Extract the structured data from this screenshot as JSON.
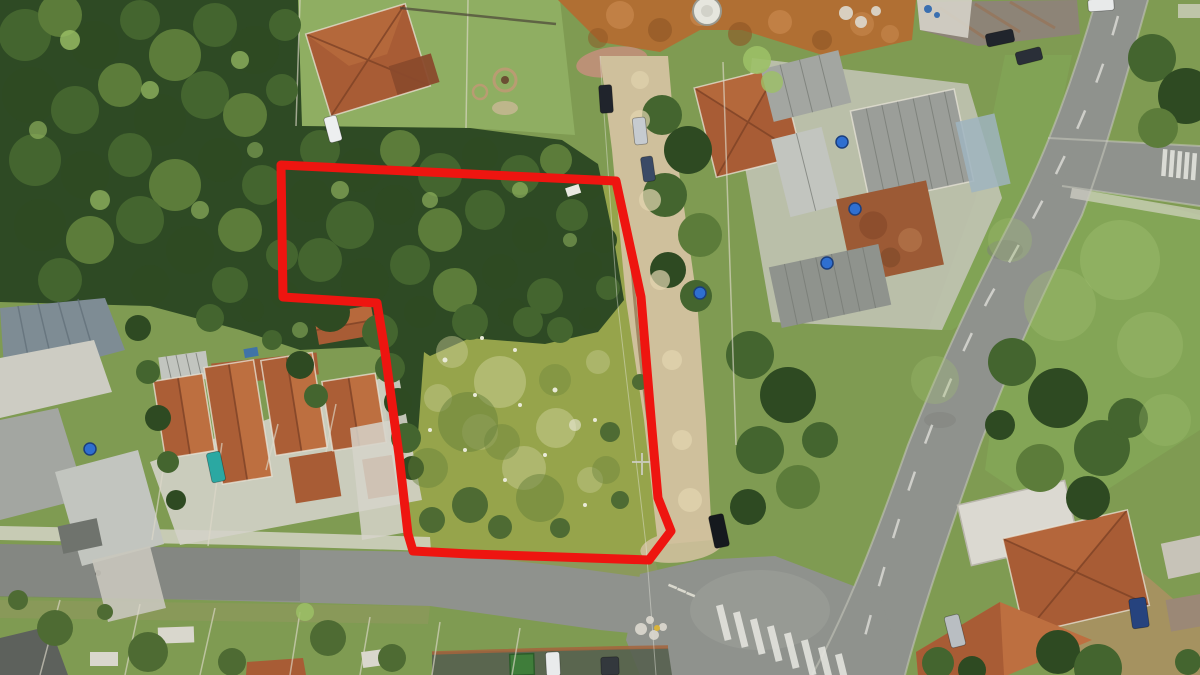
{
  "palette": {
    "grass": "#7f9b52",
    "lawn": "#8fae62",
    "field": "#84aa58",
    "fieldLight": "#a2c172",
    "lotGrass": "#96a44b",
    "lotPale": "#cbcf98",
    "lotDark": "#66803a",
    "forest": "#2e4a24",
    "f1": "#2e4a22",
    "f2": "#44652f",
    "f3": "#5c7c3a",
    "f4": "#4e6b33",
    "c2": "#9cc066",
    "dirt": "#cfc09c",
    "dL": "#e2d5b0",
    "dirtDark": "#a9946f",
    "earth": "#b06f33",
    "eL": "#c5854a",
    "eD": "#8d5524",
    "mound": "#c2907a",
    "asphalt": "#8f928d",
    "asphaltDark": "#747873",
    "asphaltLight": "#a6a9a3",
    "concrete": "#d9d7cd",
    "white": "#e9ead8",
    "w": "#e9ead8",
    "lp": "#cbcf98",
    "ld": "#66803a",
    "fl": "#a2c172",
    "roofOrange": "#a85c35",
    "roofOrangeLight": "#bd6f40",
    "roofOrangeDark": "#7e4226",
    "roofGrey": "#a3a6a1",
    "roofGreyDark": "#848781",
    "roofGreyLight": "#c2c5bf",
    "metalBlue": "#7e8c94",
    "rust": "#8d8477",
    "poolBlue": "#9fb4c0",
    "tankBlue": "#2f6fd0",
    "boundary": "#ee1510"
  },
  "boundary": {
    "points": "281,165 616,181 641,297 652,430 658,498 671,531 649,560 560,557 470,554 413,551 408,534 399,455 385,352 377,303 283,297",
    "stroke_width": 9,
    "color": "#ee1510"
  },
  "scene": {
    "blobs": [
      [
        25,
        35,
        26,
        "f2"
      ],
      [
        60,
        15,
        22,
        "f3"
      ],
      [
        95,
        45,
        24,
        "f1"
      ],
      [
        140,
        20,
        20,
        "f2"
      ],
      [
        175,
        55,
        26,
        "f3"
      ],
      [
        215,
        25,
        22,
        "f2"
      ],
      [
        255,
        50,
        24,
        "f1"
      ],
      [
        285,
        25,
        16,
        "f2"
      ],
      [
        30,
        95,
        28,
        "f1"
      ],
      [
        75,
        110,
        24,
        "f2"
      ],
      [
        120,
        85,
        22,
        "f3"
      ],
      [
        160,
        120,
        26,
        "f1"
      ],
      [
        205,
        95,
        24,
        "f2"
      ],
      [
        245,
        115,
        22,
        "f3"
      ],
      [
        282,
        90,
        16,
        "f2"
      ],
      [
        35,
        160,
        26,
        "f2"
      ],
      [
        85,
        175,
        24,
        "f1"
      ],
      [
        130,
        155,
        22,
        "f2"
      ],
      [
        175,
        185,
        26,
        "f3"
      ],
      [
        220,
        160,
        22,
        "f1"
      ],
      [
        262,
        185,
        20,
        "f2"
      ],
      [
        40,
        225,
        26,
        "f1"
      ],
      [
        90,
        240,
        24,
        "f3"
      ],
      [
        140,
        220,
        24,
        "f2"
      ],
      [
        190,
        250,
        24,
        "f1"
      ],
      [
        240,
        230,
        22,
        "f3"
      ],
      [
        282,
        255,
        16,
        "f2"
      ],
      [
        60,
        280,
        22,
        "f2"
      ],
      [
        150,
        285,
        20,
        "f1"
      ],
      [
        230,
        285,
        18,
        "f2"
      ],
      [
        285,
        295,
        14,
        "f1"
      ],
      [
        320,
        150,
        20,
        "f2"
      ],
      [
        360,
        170,
        22,
        "f1"
      ],
      [
        400,
        150,
        20,
        "f3"
      ],
      [
        440,
        175,
        22,
        "f2"
      ],
      [
        480,
        155,
        18,
        "f1"
      ],
      [
        520,
        175,
        20,
        "f2"
      ],
      [
        556,
        160,
        16,
        "f3"
      ],
      [
        588,
        186,
        14,
        "f1"
      ],
      [
        310,
        200,
        22,
        "f1"
      ],
      [
        350,
        225,
        24,
        "f2"
      ],
      [
        395,
        205,
        20,
        "f1"
      ],
      [
        440,
        230,
        22,
        "f3"
      ],
      [
        485,
        210,
        20,
        "f2"
      ],
      [
        530,
        235,
        18,
        "f1"
      ],
      [
        572,
        215,
        16,
        "f2"
      ],
      [
        604,
        240,
        13,
        "f1"
      ],
      [
        320,
        260,
        22,
        "f2"
      ],
      [
        365,
        282,
        24,
        "f1"
      ],
      [
        410,
        265,
        20,
        "f2"
      ],
      [
        455,
        290,
        22,
        "f3"
      ],
      [
        500,
        272,
        18,
        "f1"
      ],
      [
        545,
        296,
        18,
        "f2"
      ],
      [
        588,
        266,
        14,
        "f1"
      ],
      [
        608,
        288,
        12,
        "f2"
      ],
      [
        330,
        312,
        20,
        "f1"
      ],
      [
        380,
        332,
        18,
        "f2"
      ],
      [
        420,
        312,
        16,
        "f1"
      ],
      [
        470,
        322,
        18,
        "f2"
      ],
      [
        512,
        312,
        14,
        "f1"
      ],
      [
        560,
        330,
        13,
        "f2"
      ],
      [
        590,
        318,
        11,
        "f1"
      ],
      [
        70,
        40,
        10,
        "c2",
        0.8
      ],
      [
        150,
        90,
        9,
        "c2",
        0.7
      ],
      [
        240,
        60,
        9,
        "c2",
        0.7
      ],
      [
        100,
        200,
        10,
        "c2",
        0.7
      ],
      [
        200,
        210,
        9,
        "c2",
        0.6
      ],
      [
        340,
        190,
        9,
        "c2",
        0.6
      ],
      [
        430,
        200,
        8,
        "c2",
        0.6
      ],
      [
        520,
        190,
        8,
        "c2",
        0.6
      ],
      [
        300,
        330,
        8,
        "c2",
        0.5
      ],
      [
        570,
        240,
        7,
        "c2",
        0.5
      ],
      [
        38,
        130,
        9,
        "c2",
        0.6
      ],
      [
        255,
        150,
        8,
        "c2",
        0.5
      ],
      [
        390,
        368,
        15,
        "f2"
      ],
      [
        398,
        402,
        14,
        "f1"
      ],
      [
        406,
        438,
        15,
        "f2"
      ],
      [
        412,
        468,
        12,
        "f1"
      ],
      [
        300,
        365,
        14,
        "f1"
      ],
      [
        316,
        396,
        12,
        "f2"
      ],
      [
        210,
        318,
        14,
        "f2"
      ],
      [
        252,
        310,
        12,
        "f1"
      ],
      [
        272,
        340,
        10,
        "f2"
      ],
      [
        138,
        328,
        13,
        "f1"
      ],
      [
        148,
        372,
        12,
        "f2"
      ],
      [
        158,
        418,
        13,
        "f1"
      ],
      [
        168,
        462,
        11,
        "f2"
      ],
      [
        176,
        500,
        10,
        "f1"
      ],
      [
        662,
        115,
        20,
        "f2"
      ],
      [
        688,
        150,
        24,
        "f1"
      ],
      [
        665,
        195,
        22,
        "f2"
      ],
      [
        700,
        235,
        22,
        "f3"
      ],
      [
        668,
        270,
        18,
        "f1"
      ],
      [
        696,
        296,
        16,
        "f2"
      ],
      [
        757,
        60,
        14,
        "c2",
        0.9
      ],
      [
        772,
        82,
        11,
        "c2",
        0.8
      ],
      [
        750,
        355,
        24,
        "f2"
      ],
      [
        788,
        395,
        28,
        "f1"
      ],
      [
        760,
        450,
        24,
        "f2"
      ],
      [
        798,
        487,
        22,
        "f3"
      ],
      [
        748,
        507,
        18,
        "f1"
      ],
      [
        820,
        440,
        18,
        "f2"
      ],
      [
        1152,
        58,
        24,
        "f2"
      ],
      [
        1186,
        96,
        28,
        "f1"
      ],
      [
        1158,
        128,
        20,
        "f3"
      ],
      [
        1012,
        362,
        24,
        "f2"
      ],
      [
        1058,
        398,
        30,
        "f1"
      ],
      [
        1102,
        448,
        28,
        "f2"
      ],
      [
        1040,
        468,
        24,
        "f3"
      ],
      [
        1088,
        498,
        22,
        "f1"
      ],
      [
        1128,
        418,
        20,
        "f2"
      ],
      [
        1000,
        425,
        15,
        "f1"
      ],
      [
        1058,
        652,
        22,
        "f1"
      ],
      [
        1098,
        668,
        24,
        "f2"
      ],
      [
        938,
        663,
        16,
        "f2"
      ],
      [
        972,
        670,
        14,
        "f1"
      ],
      [
        1188,
        662,
        13,
        "f2"
      ],
      [
        55,
        628,
        18,
        "f4"
      ],
      [
        148,
        652,
        20,
        "f4"
      ],
      [
        328,
        638,
        18,
        "f4"
      ],
      [
        392,
        658,
        14,
        "f4"
      ],
      [
        232,
        662,
        14,
        "f4"
      ],
      [
        18,
        600,
        10,
        "f4"
      ],
      [
        105,
        612,
        8,
        "f4"
      ],
      [
        305,
        612,
        9,
        "c2",
        0.85
      ],
      [
        528,
        322,
        15,
        "f2"
      ],
      [
        470,
        505,
        18,
        "f4"
      ],
      [
        432,
        520,
        13,
        "f4"
      ],
      [
        500,
        527,
        12,
        "f4"
      ],
      [
        560,
        528,
        10,
        "f4"
      ],
      [
        610,
        432,
        10,
        "f4"
      ],
      [
        640,
        382,
        8,
        "f4"
      ],
      [
        620,
        500,
        9,
        "f4"
      ],
      [
        500,
        382,
        26,
        "lp",
        0.5
      ],
      [
        556,
        428,
        20,
        "lp",
        0.5
      ],
      [
        452,
        352,
        16,
        "lp",
        0.45
      ],
      [
        524,
        468,
        22,
        "lp",
        0.45
      ],
      [
        598,
        362,
        12,
        "lp",
        0.4
      ],
      [
        438,
        398,
        14,
        "lp",
        0.4
      ],
      [
        590,
        480,
        13,
        "lp",
        0.4
      ],
      [
        480,
        432,
        18,
        "lp",
        0.35
      ],
      [
        468,
        422,
        30,
        "ld",
        0.5
      ],
      [
        540,
        498,
        24,
        "ld",
        0.5
      ],
      [
        428,
        468,
        20,
        "ld",
        0.45
      ],
      [
        606,
        470,
        14,
        "ld",
        0.4
      ],
      [
        502,
        442,
        18,
        "ld",
        0.4
      ],
      [
        555,
        380,
        16,
        "ld",
        0.35
      ],
      [
        445,
        360,
        2.5,
        "w"
      ],
      [
        475,
        395,
        2,
        "w"
      ],
      [
        515,
        350,
        2,
        "w"
      ],
      [
        555,
        390,
        2.5,
        "w"
      ],
      [
        595,
        420,
        2,
        "w"
      ],
      [
        465,
        450,
        2,
        "w"
      ],
      [
        505,
        480,
        2,
        "w"
      ],
      [
        545,
        455,
        2,
        "w"
      ],
      [
        430,
        430,
        2,
        "w"
      ],
      [
        585,
        505,
        2,
        "w"
      ],
      [
        520,
        405,
        2,
        "w"
      ],
      [
        482,
        338,
        2,
        "w"
      ],
      [
        575,
        425,
        6,
        "w",
        0.6
      ],
      [
        1120,
        260,
        40,
        "fl",
        0.4
      ],
      [
        1060,
        305,
        36,
        "fl",
        0.35
      ],
      [
        1150,
        345,
        33,
        "fl",
        0.35
      ],
      [
        1165,
        420,
        26,
        "fl",
        0.3
      ],
      [
        935,
        380,
        24,
        "fl",
        0.3
      ],
      [
        1010,
        240,
        22,
        "fl",
        0.3
      ],
      [
        620,
        15,
        14,
        "eL",
        0.8
      ],
      [
        660,
        30,
        12,
        "eD",
        0.6
      ],
      [
        700,
        16,
        10,
        "eL",
        0.8
      ],
      [
        740,
        34,
        12,
        "eD",
        0.6
      ],
      [
        780,
        22,
        12,
        "eL",
        0.8
      ],
      [
        822,
        40,
        10,
        "eD",
        0.6
      ],
      [
        862,
        24,
        12,
        "eL",
        0.7
      ],
      [
        598,
        38,
        10,
        "eD",
        0.5
      ],
      [
        890,
        34,
        9,
        "eL",
        0.7
      ],
      [
        640,
        80,
        9,
        "dL",
        0.6
      ],
      [
        640,
        120,
        10,
        "dL",
        0.7
      ],
      [
        650,
        200,
        11,
        "dL",
        0.7
      ],
      [
        660,
        280,
        10,
        "dL",
        0.7
      ],
      [
        672,
        360,
        10,
        "dL",
        0.7
      ],
      [
        682,
        440,
        10,
        "dL",
        0.7
      ],
      [
        690,
        500,
        12,
        "dL",
        0.7
      ]
    ],
    "cars": [
      [
        606,
        99,
        13,
        28,
        -4,
        "#20242c"
      ],
      [
        640,
        131,
        13,
        27,
        -6,
        "#c6cbd0"
      ],
      [
        648,
        169,
        12,
        25,
        -8,
        "#3a4a66"
      ],
      [
        719,
        531,
        15,
        33,
        -12,
        "#15191e"
      ],
      [
        333,
        129,
        13,
        26,
        -15,
        "#edeff0"
      ],
      [
        216,
        467,
        14,
        30,
        -12,
        "#2ba8a2"
      ],
      [
        1000,
        38,
        28,
        13,
        -12,
        "#20242c"
      ],
      [
        1029,
        56,
        26,
        13,
        -14,
        "#2a2f38"
      ],
      [
        1101,
        5,
        26,
        12,
        -4,
        "#e8eaea"
      ],
      [
        955,
        631,
        15,
        32,
        -14,
        "#b9bec2"
      ],
      [
        1139,
        613,
        17,
        30,
        -8,
        "#26437e"
      ],
      [
        553,
        664,
        14,
        24,
        -3,
        "#e9ebec"
      ],
      [
        610,
        666,
        18,
        18,
        -2,
        "#33383d"
      ]
    ],
    "tanks": [
      [
        842,
        142
      ],
      [
        855,
        209
      ],
      [
        827,
        263
      ],
      [
        700,
        293
      ],
      [
        90,
        449
      ]
    ],
    "debris_white": [
      [
        846,
        13,
        7
      ],
      [
        861,
        22,
        6
      ],
      [
        876,
        11,
        5
      ],
      [
        641,
        629,
        6
      ],
      [
        654,
        635,
        5
      ],
      [
        663,
        627,
        4
      ],
      [
        650,
        620,
        4
      ]
    ],
    "debris_yellow": [
      [
        657,
        628,
        3
      ]
    ],
    "debris_blue": [
      [
        928,
        9,
        4
      ],
      [
        937,
        15,
        3
      ]
    ],
    "crosswalks": [
      {
        "x": 716,
        "y": 606,
        "dx": 17,
        "dy": 7,
        "w": 7,
        "h": 36,
        "rot": -14,
        "n": 8
      },
      {
        "x": 1163,
        "y": 149,
        "dx": 7.4,
        "dy": 1,
        "w": 4.5,
        "h": 27,
        "rot": 4,
        "n": 5
      }
    ]
  }
}
